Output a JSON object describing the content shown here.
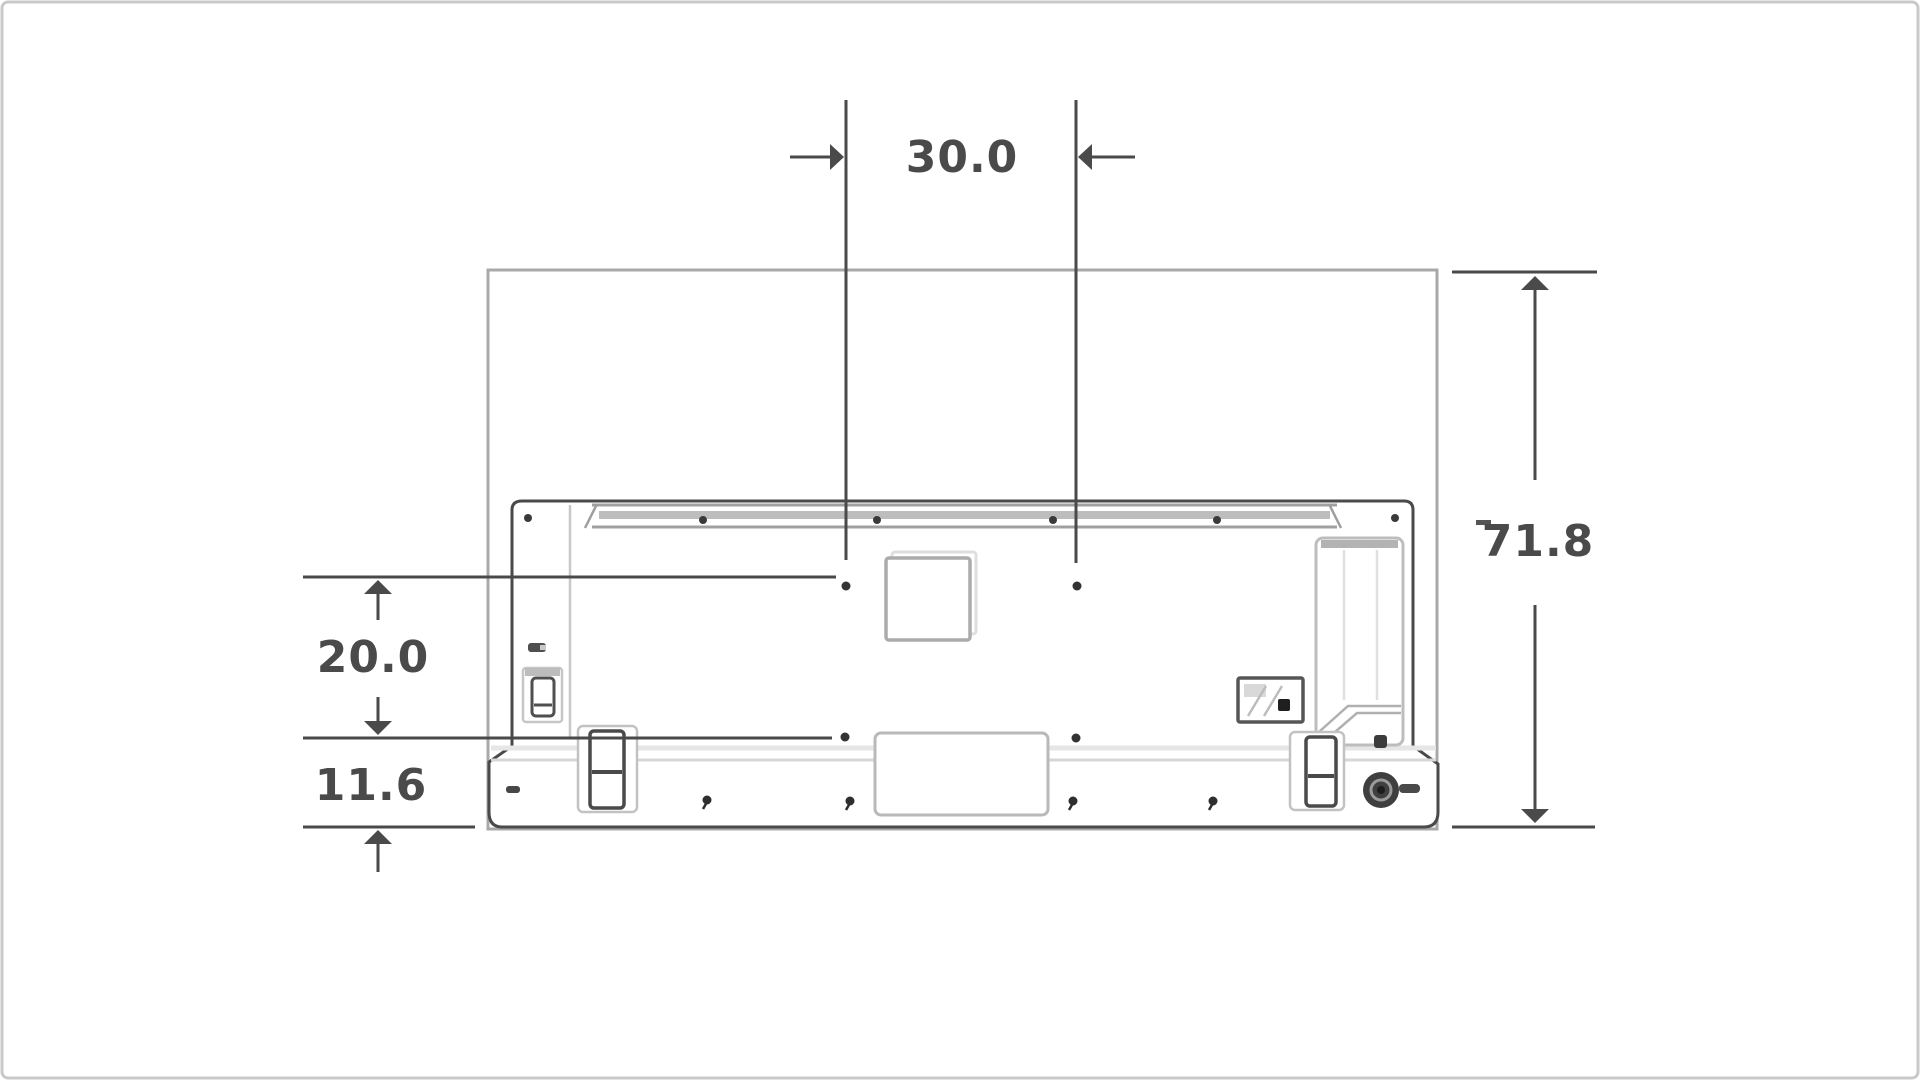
{
  "diagram": {
    "title": "tv-rear-vesa-mount-dimension-diagram",
    "labels": {
      "hole_spacing_horizontal": "30.0",
      "panel_height": "71.8",
      "hole_spacing_vertical": "20.0",
      "bottom_offset": "11.6"
    },
    "colors": {
      "dimension": "#4a4a4a",
      "tv_outline": "#4a4a4a",
      "panel_frame": "#a9a9a9",
      "detail_gray": "#b5b5b5",
      "light_band": "#e2e2e2",
      "canvas_border": "#c9c9c9"
    }
  }
}
